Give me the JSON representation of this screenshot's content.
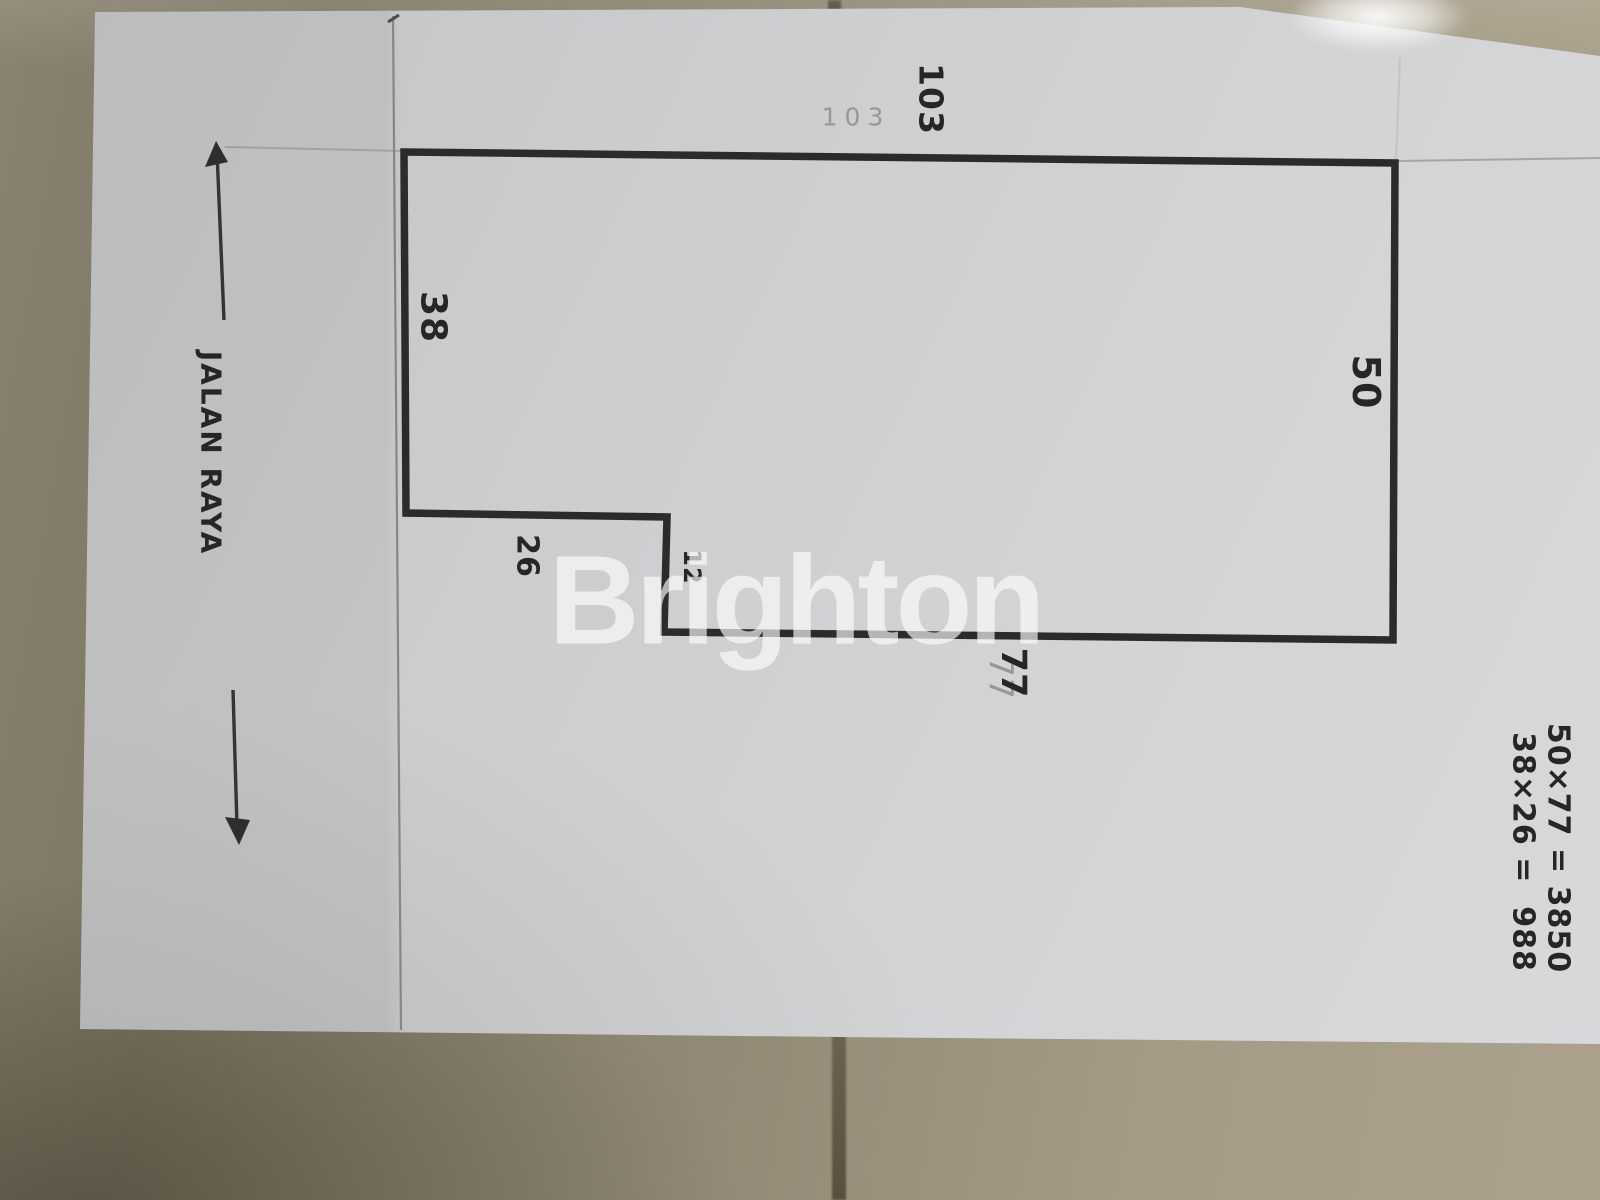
{
  "scene": "photo of a hand-drawn land-plot sketch on paper lying on beige floor tiles",
  "watermark": {
    "text": "Brighton"
  },
  "road": {
    "label": "JALAN RAYA",
    "arrows": [
      "up",
      "down"
    ]
  },
  "plot": {
    "shape": "rectangle with notched lower-left corner",
    "dimensions": {
      "top_pen": "103",
      "top_pencil": "103",
      "left": "38",
      "right": "50",
      "notch_width": "26",
      "notch_depth": "12",
      "bottom_pen": "77",
      "bottom_pencil": "77"
    }
  },
  "calculations": {
    "line1": "50×77 = 3850",
    "line2": "38×26 =  988"
  },
  "colors": {
    "ink": "#262624",
    "pencil": "#97979a",
    "paper": "#cfd1d2",
    "floor": "#948b77",
    "grout": "#5e5644",
    "watermark": "#fdfdfb"
  }
}
